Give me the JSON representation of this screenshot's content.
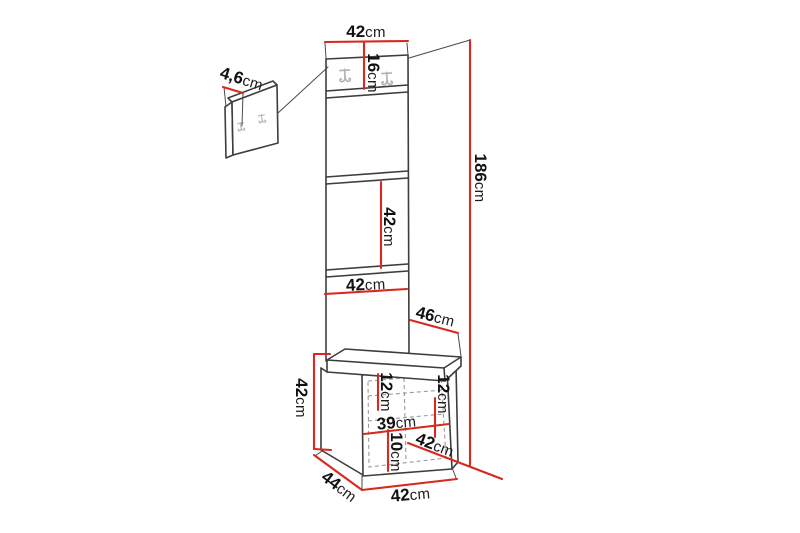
{
  "figure": {
    "type": "furniture-dimension-diagram",
    "background": "#ffffff",
    "line_color": "#3d3d3d",
    "dimension_line_color": "#d9281e",
    "hidden_line_color": "#9a9a9a",
    "hook_color": "#b2b2b2"
  },
  "icons": {
    "coat_hook": "double-prong-wall-hook"
  },
  "dimensions": {
    "panel_width_top": {
      "value": "42",
      "unit": "cm"
    },
    "hook_panel_height": {
      "value": "16",
      "unit": "cm"
    },
    "wall_panel_thickness": {
      "value": "4,6",
      "unit": "cm"
    },
    "total_height": {
      "value": "186",
      "unit": "cm"
    },
    "panel_section_height": {
      "value": "42",
      "unit": "cm"
    },
    "panel_width_lower": {
      "value": "42",
      "unit": "cm"
    },
    "depth_at_seat": {
      "value": "46",
      "unit": "cm"
    },
    "bench_height": {
      "value": "42",
      "unit": "cm"
    },
    "shelf_spacing_left": {
      "value": "12",
      "unit": "cm"
    },
    "shelf_spacing_right": {
      "value": "12",
      "unit": "cm"
    },
    "interior_width": {
      "value": "39",
      "unit": "cm"
    },
    "bottom_clearance": {
      "value": "10",
      "unit": "cm"
    },
    "seat_depth": {
      "value": "42",
      "unit": "cm"
    },
    "bench_depth": {
      "value": "44",
      "unit": "cm"
    },
    "bench_width": {
      "value": "42",
      "unit": "cm"
    }
  }
}
